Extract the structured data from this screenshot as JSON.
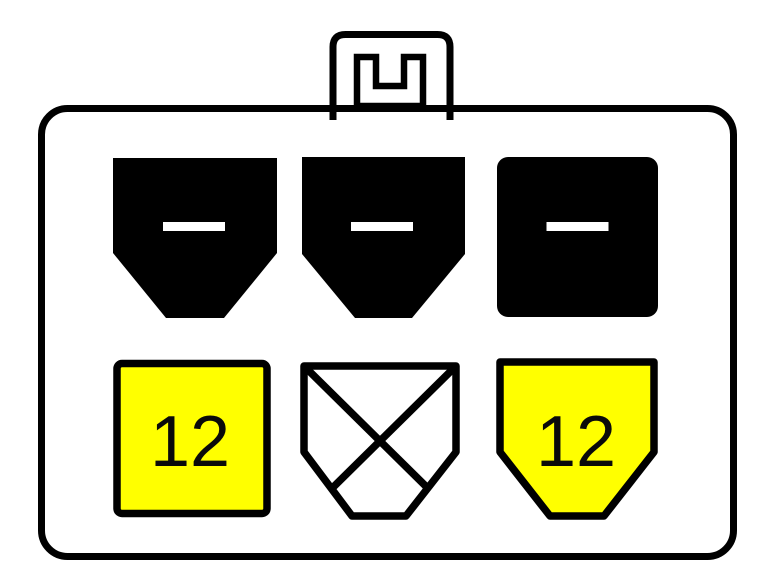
{
  "diagram": {
    "kind": "6-pin connector pinout",
    "colors": {
      "background": "#ffffff",
      "body_gray": "#b1b1b1",
      "outline_black": "#000000",
      "pin_black": "#000000",
      "pin_yellow": "#ffff00",
      "pin_white": "#ffffff",
      "dash_white": "#ffffff"
    },
    "latch": {
      "notch_shape": "u-channel"
    },
    "pins": [
      {
        "position": "top-left",
        "shape": "pentagon-down",
        "mark": "minus-dash",
        "label": ""
      },
      {
        "position": "top-middle",
        "shape": "pentagon-down",
        "mark": "minus-dash",
        "label": ""
      },
      {
        "position": "top-right",
        "shape": "rounded-square",
        "mark": "minus-dash",
        "label": ""
      },
      {
        "position": "bottom-left",
        "shape": "rounded-square",
        "mark": "none",
        "label": "12"
      },
      {
        "position": "bottom-middle",
        "shape": "pentagon-down",
        "mark": "x-cross",
        "label": ""
      },
      {
        "position": "bottom-right",
        "shape": "pentagon-down",
        "mark": "none",
        "label": "12"
      }
    ]
  }
}
